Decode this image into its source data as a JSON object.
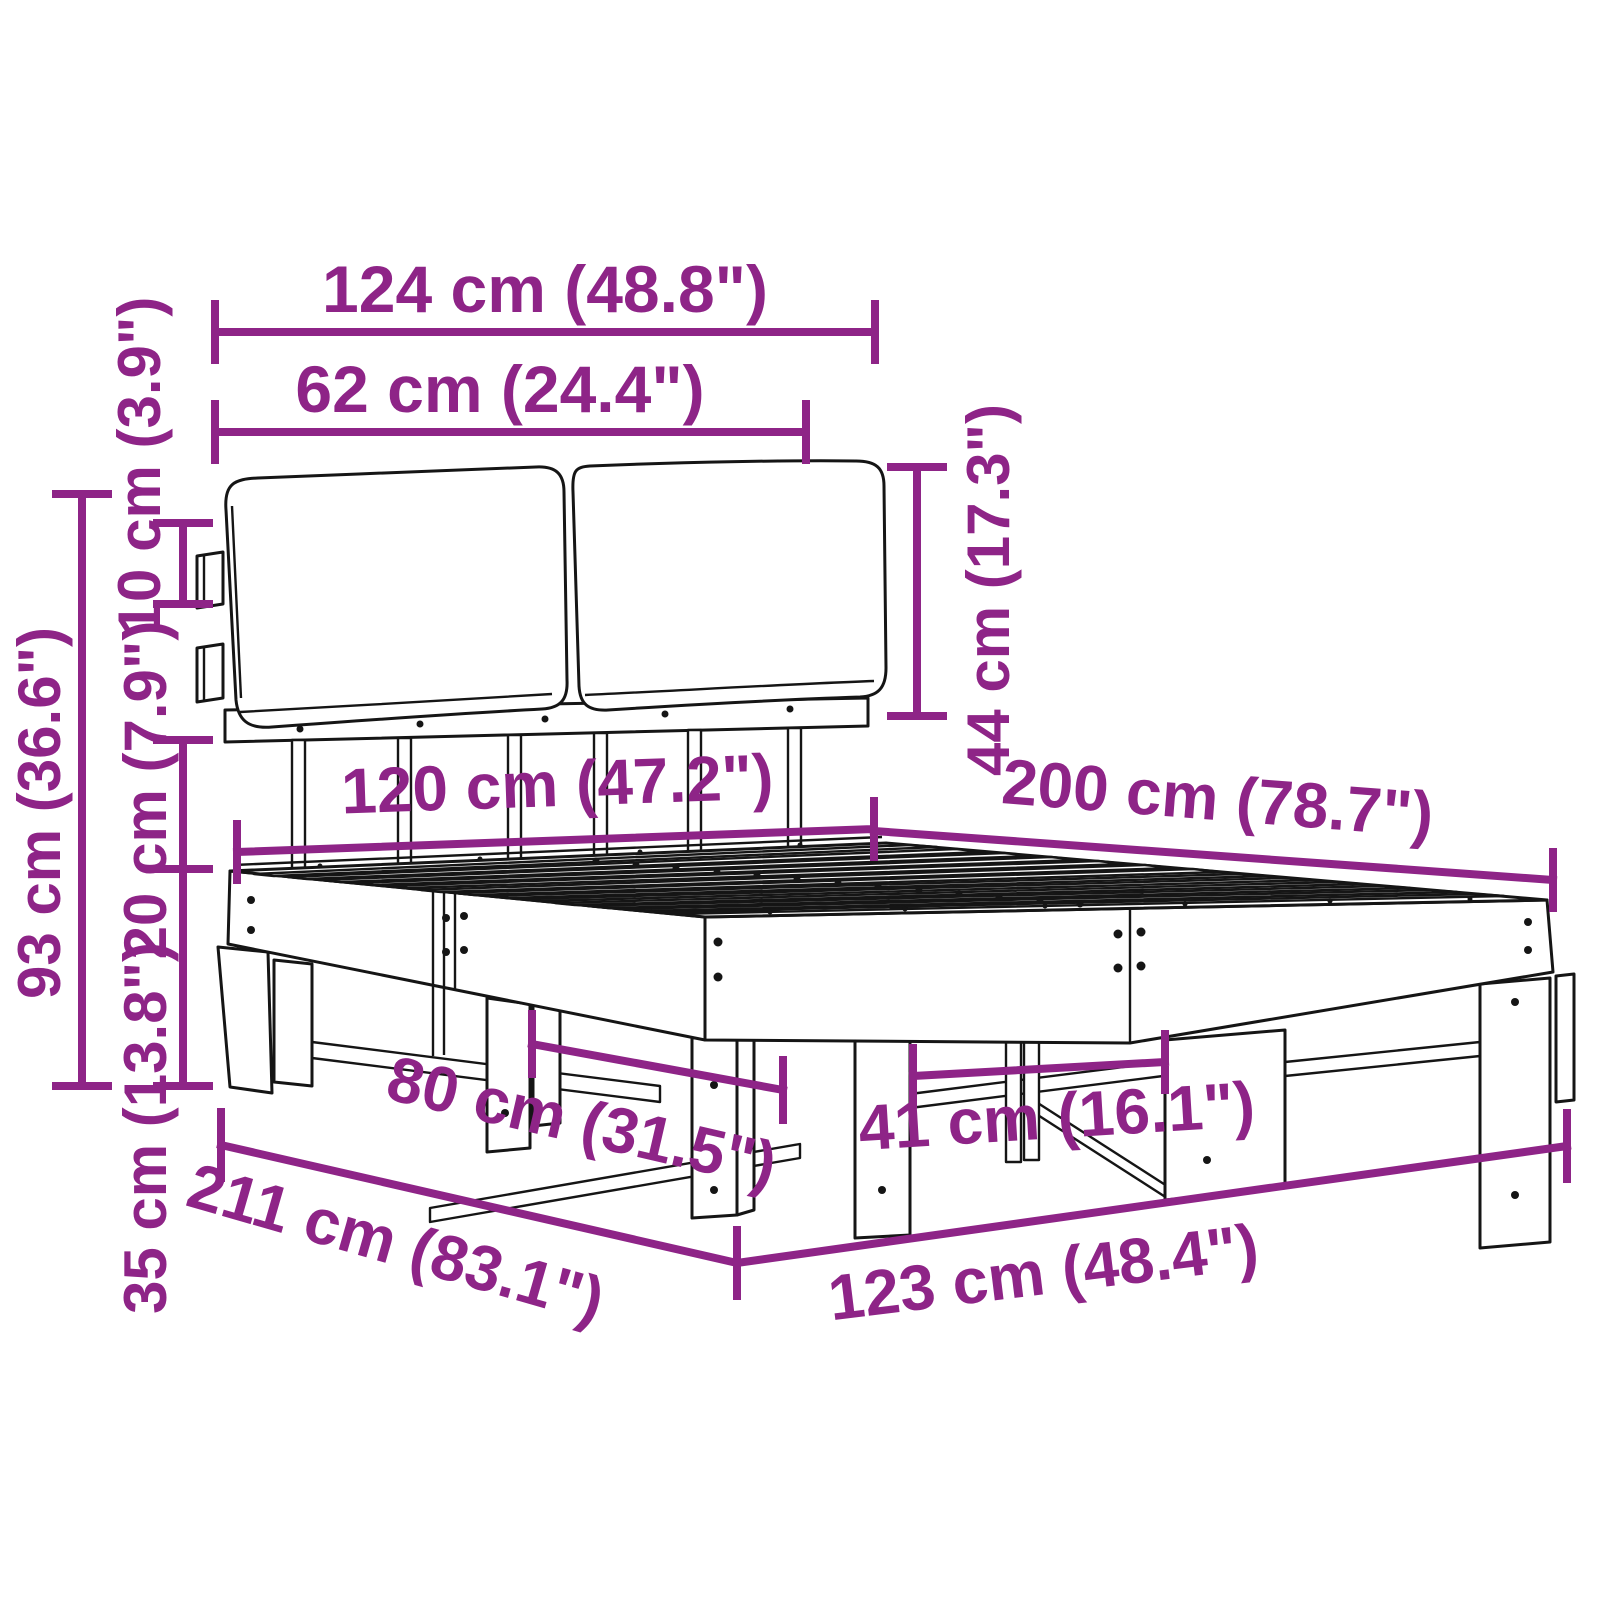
{
  "diagram": {
    "kind": "furniture-dimension-line-drawing",
    "subject": "bed frame with two headboard cushions, slatted base and wooden legs",
    "colors": {
      "accent": "#8e2487",
      "line": "#151515",
      "background": "#ffffff"
    },
    "dims": {
      "headboard_width": "124 cm (48.8\")",
      "cushion_width": "62 cm (24.4\")",
      "cushion_height": "44 cm (17.3\")",
      "bracket_offset": "10 cm (3.9\")",
      "overall_height": "93 cm (36.6\")",
      "frame_height": "20 cm (7.9\")",
      "leg_height": "35 cm (13.8\")",
      "bed_width": "120 cm (47.2\")",
      "bed_length": "200 cm (78.7\")",
      "leg_span_head": "80 cm (31.5\")",
      "leg_span_foot": "41 cm (16.1\")",
      "overall_length": "211 cm (83.1\")",
      "overall_width": "123 cm (48.4\")"
    }
  }
}
